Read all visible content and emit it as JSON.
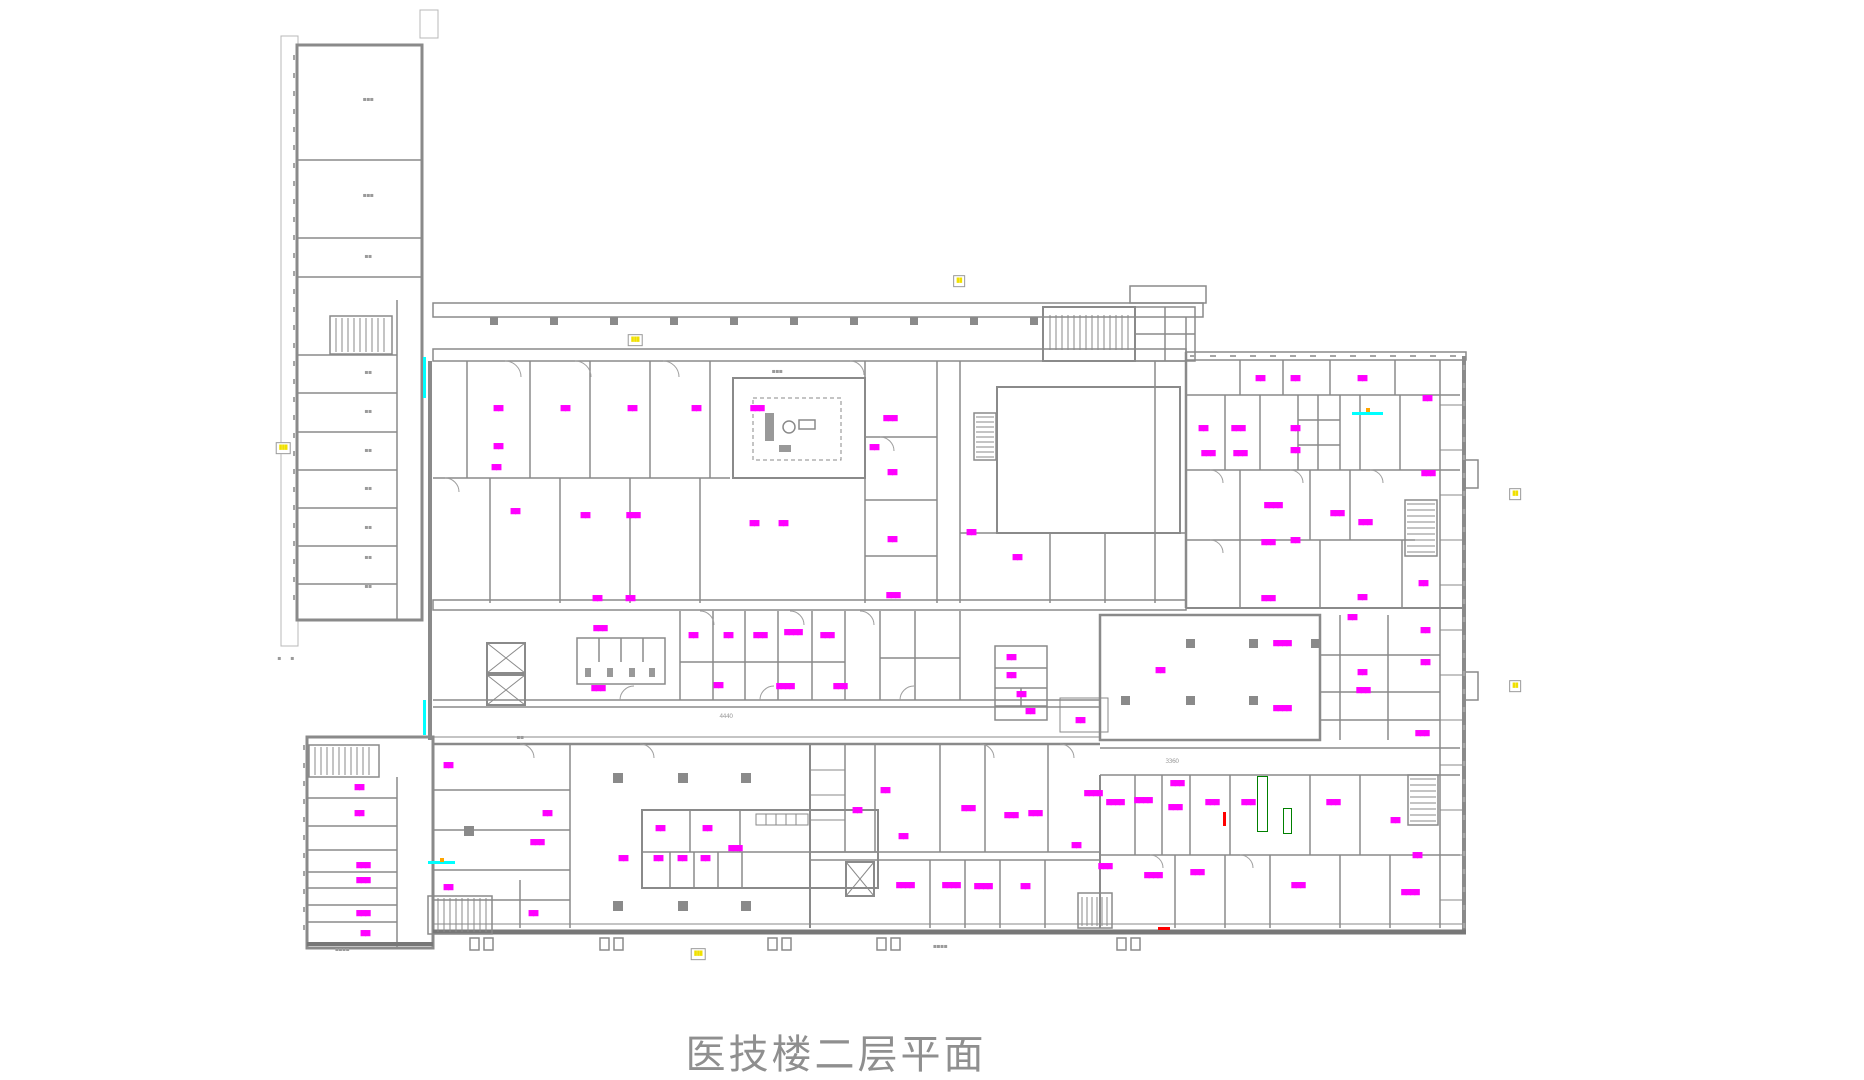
{
  "title": "医技楼二层平面",
  "note": "CAD floor plan; room-name strings are rendered below legibility in the source image and are represented as block glyphs at their true positions",
  "colors": {
    "wall": "#8a8a8a",
    "room_label": "#ff00ff",
    "dim_label": "#9a9a9a",
    "highlight_tag": "#f0e000",
    "utility_line": "#00ffff",
    "alert_mark": "#ff0000",
    "equipment_mark": "#008000",
    "title_text": "#8f8f8f",
    "background": "#ffffff"
  },
  "room_labels": [
    {
      "x": 498,
      "y": 408,
      "t": "▆▆"
    },
    {
      "x": 565,
      "y": 408,
      "t": "▆▆"
    },
    {
      "x": 632,
      "y": 408,
      "t": "▆▆"
    },
    {
      "x": 696,
      "y": 408,
      "t": "▆▆"
    },
    {
      "x": 498,
      "y": 446,
      "t": "▆▆"
    },
    {
      "x": 496,
      "y": 467,
      "t": "▆▆"
    },
    {
      "x": 515,
      "y": 511,
      "t": "▆▆"
    },
    {
      "x": 585,
      "y": 515,
      "t": "▆▆"
    },
    {
      "x": 633,
      "y": 515,
      "t": "▆▆▆"
    },
    {
      "x": 597,
      "y": 598,
      "t": "▆▆"
    },
    {
      "x": 630,
      "y": 598,
      "t": "▆▆"
    },
    {
      "x": 757,
      "y": 408,
      "t": "▆▆▆"
    },
    {
      "x": 890,
      "y": 418,
      "t": "▆▆▆"
    },
    {
      "x": 874,
      "y": 447,
      "t": "▆▆"
    },
    {
      "x": 892,
      "y": 472,
      "t": "▆▆"
    },
    {
      "x": 754,
      "y": 523,
      "t": "▆▆"
    },
    {
      "x": 783,
      "y": 523,
      "t": "▆▆"
    },
    {
      "x": 892,
      "y": 539,
      "t": "▆▆"
    },
    {
      "x": 971,
      "y": 532,
      "t": "▆▆"
    },
    {
      "x": 1017,
      "y": 557,
      "t": "▆▆"
    },
    {
      "x": 893,
      "y": 595,
      "t": "▆▆▆"
    },
    {
      "x": 1260,
      "y": 378,
      "t": "▆▆"
    },
    {
      "x": 1295,
      "y": 378,
      "t": "▆▆"
    },
    {
      "x": 1362,
      "y": 378,
      "t": "▆▆"
    },
    {
      "x": 1427,
      "y": 398,
      "t": "▆▆"
    },
    {
      "x": 1203,
      "y": 428,
      "t": "▆▆"
    },
    {
      "x": 1238,
      "y": 428,
      "t": "▆▆▆"
    },
    {
      "x": 1295,
      "y": 428,
      "t": "▆▆"
    },
    {
      "x": 1208,
      "y": 453,
      "t": "▆▆▆"
    },
    {
      "x": 1240,
      "y": 453,
      "t": "▆▆▆"
    },
    {
      "x": 1295,
      "y": 450,
      "t": "▆▆"
    },
    {
      "x": 1428,
      "y": 473,
      "t": "▆▆▆"
    },
    {
      "x": 1273,
      "y": 505,
      "t": "▆▆▆▆"
    },
    {
      "x": 1337,
      "y": 513,
      "t": "▆▆▆"
    },
    {
      "x": 1365,
      "y": 522,
      "t": "▆▆▆"
    },
    {
      "x": 1268,
      "y": 542,
      "t": "▆▆▆"
    },
    {
      "x": 1295,
      "y": 540,
      "t": "▆▆"
    },
    {
      "x": 1268,
      "y": 598,
      "t": "▆▆▆"
    },
    {
      "x": 1362,
      "y": 597,
      "t": "▆▆"
    },
    {
      "x": 1423,
      "y": 583,
      "t": "▆▆"
    },
    {
      "x": 600,
      "y": 628,
      "t": "▆▆▆"
    },
    {
      "x": 598,
      "y": 688,
      "t": "▆▆▆"
    },
    {
      "x": 693,
      "y": 635,
      "t": "▆▆"
    },
    {
      "x": 728,
      "y": 635,
      "t": "▆▆"
    },
    {
      "x": 760,
      "y": 635,
      "t": "▆▆▆"
    },
    {
      "x": 793,
      "y": 632,
      "t": "▆▆▆▆"
    },
    {
      "x": 827,
      "y": 635,
      "t": "▆▆▆"
    },
    {
      "x": 718,
      "y": 685,
      "t": "▆▆"
    },
    {
      "x": 785,
      "y": 686,
      "t": "▆▆▆▆"
    },
    {
      "x": 840,
      "y": 686,
      "t": "▆▆▆"
    },
    {
      "x": 1011,
      "y": 657,
      "t": "▆▆"
    },
    {
      "x": 1011,
      "y": 675,
      "t": "▆▆"
    },
    {
      "x": 1021,
      "y": 694,
      "t": "▆▆"
    },
    {
      "x": 1030,
      "y": 711,
      "t": "▆▆"
    },
    {
      "x": 1080,
      "y": 720,
      "t": "▆▆"
    },
    {
      "x": 1160,
      "y": 670,
      "t": "▆▆"
    },
    {
      "x": 1282,
      "y": 643,
      "t": "▆▆▆▆"
    },
    {
      "x": 1282,
      "y": 708,
      "t": "▆▆▆▆"
    },
    {
      "x": 1352,
      "y": 617,
      "t": "▆▆"
    },
    {
      "x": 1362,
      "y": 672,
      "t": "▆▆"
    },
    {
      "x": 1363,
      "y": 690,
      "t": "▆▆▆"
    },
    {
      "x": 1425,
      "y": 630,
      "t": "▆▆"
    },
    {
      "x": 1425,
      "y": 662,
      "t": "▆▆"
    },
    {
      "x": 1422,
      "y": 733,
      "t": "▆▆▆"
    },
    {
      "x": 448,
      "y": 765,
      "t": "▆▆"
    },
    {
      "x": 547,
      "y": 813,
      "t": "▆▆"
    },
    {
      "x": 537,
      "y": 842,
      "t": "▆▆▆"
    },
    {
      "x": 448,
      "y": 887,
      "t": "▆▆"
    },
    {
      "x": 533,
      "y": 913,
      "t": "▆▆"
    },
    {
      "x": 660,
      "y": 828,
      "t": "▆▆"
    },
    {
      "x": 707,
      "y": 828,
      "t": "▆▆"
    },
    {
      "x": 623,
      "y": 858,
      "t": "▆▆"
    },
    {
      "x": 658,
      "y": 858,
      "t": "▆▆"
    },
    {
      "x": 682,
      "y": 858,
      "t": "▆▆"
    },
    {
      "x": 705,
      "y": 858,
      "t": "▆▆"
    },
    {
      "x": 735,
      "y": 848,
      "t": "▆▆▆"
    },
    {
      "x": 857,
      "y": 810,
      "t": "▆▆"
    },
    {
      "x": 885,
      "y": 790,
      "t": "▆▆"
    },
    {
      "x": 903,
      "y": 836,
      "t": "▆▆"
    },
    {
      "x": 968,
      "y": 808,
      "t": "▆▆▆"
    },
    {
      "x": 1011,
      "y": 815,
      "t": "▆▆▆"
    },
    {
      "x": 1035,
      "y": 813,
      "t": "▆▆▆"
    },
    {
      "x": 1076,
      "y": 845,
      "t": "▆▆"
    },
    {
      "x": 1093,
      "y": 793,
      "t": "▆▆▆▆"
    },
    {
      "x": 905,
      "y": 885,
      "t": "▆▆▆▆"
    },
    {
      "x": 951,
      "y": 885,
      "t": "▆▆▆▆"
    },
    {
      "x": 983,
      "y": 886,
      "t": "▆▆▆▆"
    },
    {
      "x": 1025,
      "y": 886,
      "t": "▆▆"
    },
    {
      "x": 1105,
      "y": 866,
      "t": "▆▆▆"
    },
    {
      "x": 1115,
      "y": 802,
      "t": "▆▆▆▆"
    },
    {
      "x": 1143,
      "y": 800,
      "t": "▆▆▆▆"
    },
    {
      "x": 1177,
      "y": 783,
      "t": "▆▆▆"
    },
    {
      "x": 1175,
      "y": 807,
      "t": "▆▆▆"
    },
    {
      "x": 1212,
      "y": 802,
      "t": "▆▆▆"
    },
    {
      "x": 1248,
      "y": 802,
      "t": "▆▆▆"
    },
    {
      "x": 1333,
      "y": 802,
      "t": "▆▆▆"
    },
    {
      "x": 1395,
      "y": 820,
      "t": "▆▆"
    },
    {
      "x": 1417,
      "y": 855,
      "t": "▆▆"
    },
    {
      "x": 1153,
      "y": 875,
      "t": "▆▆▆▆"
    },
    {
      "x": 1197,
      "y": 872,
      "t": "▆▆▆"
    },
    {
      "x": 1298,
      "y": 885,
      "t": "▆▆▆"
    },
    {
      "x": 1410,
      "y": 892,
      "t": "▆▆▆▆"
    },
    {
      "x": 359,
      "y": 787,
      "t": "▆▆"
    },
    {
      "x": 359,
      "y": 813,
      "t": "▆▆"
    },
    {
      "x": 363,
      "y": 865,
      "t": "▆▆▆"
    },
    {
      "x": 363,
      "y": 880,
      "t": "▆▆▆"
    },
    {
      "x": 363,
      "y": 913,
      "t": "▆▆▆"
    },
    {
      "x": 365,
      "y": 933,
      "t": "▆▆"
    }
  ],
  "dim_labels": [
    {
      "x": 368,
      "y": 100,
      "t": "▪▪▪"
    },
    {
      "x": 368,
      "y": 196,
      "t": "▪▪▪"
    },
    {
      "x": 368,
      "y": 257,
      "t": "▪▪"
    },
    {
      "x": 368,
      "y": 373,
      "t": "▪▪"
    },
    {
      "x": 368,
      "y": 412,
      "t": "▪▪"
    },
    {
      "x": 368,
      "y": 451,
      "t": "▪▪"
    },
    {
      "x": 368,
      "y": 489,
      "t": "▪▪"
    },
    {
      "x": 368,
      "y": 528,
      "t": "▪▪"
    },
    {
      "x": 368,
      "y": 558,
      "t": "▪▪"
    },
    {
      "x": 368,
      "y": 587,
      "t": "▪▪"
    },
    {
      "x": 777,
      "y": 372,
      "t": "▪▪▪"
    },
    {
      "x": 520,
      "y": 738,
      "t": "▪▪"
    },
    {
      "x": 726,
      "y": 717,
      "t": "4440"
    },
    {
      "x": 1172,
      "y": 762,
      "t": "3360"
    },
    {
      "x": 940,
      "y": 947,
      "t": "▪▪▪▪"
    },
    {
      "x": 342,
      "y": 950,
      "t": "▪▪▪▪"
    },
    {
      "x": 279,
      "y": 659,
      "t": "▪"
    },
    {
      "x": 292,
      "y": 659,
      "t": "▪"
    }
  ],
  "yellow_tags": [
    {
      "x": 635,
      "y": 340,
      "t": "▮▮▮"
    },
    {
      "x": 959,
      "y": 281,
      "t": "▮▮"
    },
    {
      "x": 283,
      "y": 448,
      "t": "▮▮▮"
    },
    {
      "x": 1515,
      "y": 494,
      "t": "▮▮"
    },
    {
      "x": 1515,
      "y": 686,
      "t": "▮▮"
    },
    {
      "x": 698,
      "y": 954,
      "t": "▮▮▮"
    }
  ],
  "cyan_marks": [
    {
      "x": 423,
      "y": 357,
      "w": 3,
      "h": 41
    },
    {
      "x": 423,
      "y": 700,
      "w": 3,
      "h": 35
    },
    {
      "x": 428,
      "y": 861,
      "w": 27,
      "h": 3
    },
    {
      "x": 1352,
      "y": 412,
      "w": 31,
      "h": 3
    }
  ],
  "orange_marks": [
    {
      "x": 440,
      "y": 858,
      "w": 4,
      "h": 4
    },
    {
      "x": 1366,
      "y": 408,
      "w": 4,
      "h": 4
    }
  ],
  "red_marks": [
    {
      "x": 1223,
      "y": 812,
      "w": 3,
      "h": 14
    },
    {
      "x": 1158,
      "y": 927,
      "w": 12,
      "h": 3
    }
  ],
  "green_marks": [
    {
      "x": 1257,
      "y": 776,
      "w": 11,
      "h": 56
    },
    {
      "x": 1283,
      "y": 808,
      "w": 9,
      "h": 26
    }
  ]
}
